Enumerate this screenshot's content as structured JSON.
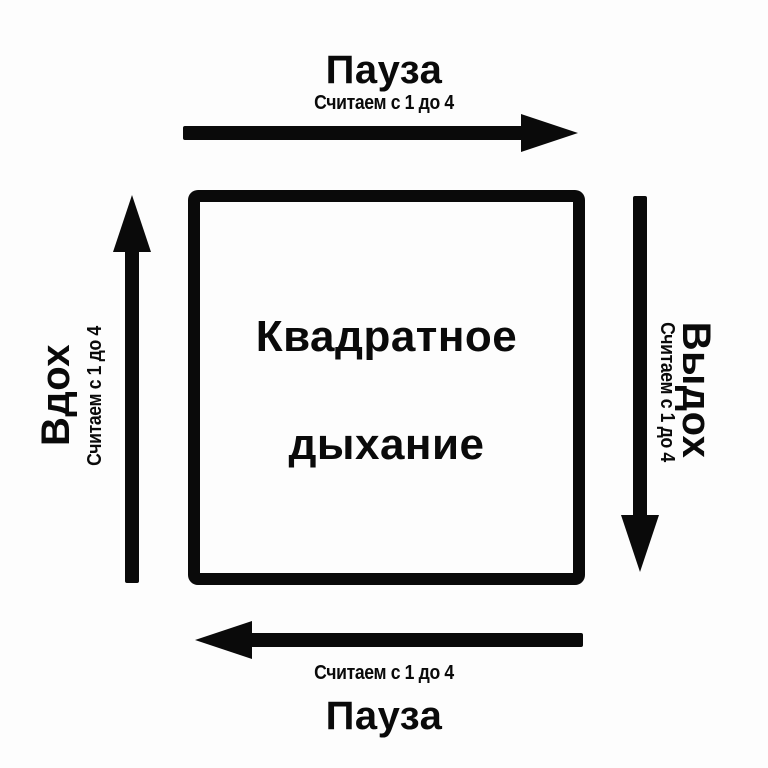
{
  "diagram": {
    "kind": "box-breathing-cycle",
    "title": {
      "line1": "Квадратное",
      "line2": "дыхание"
    }
  },
  "sides": {
    "top": {
      "label": "Пауза",
      "count_note": "Считаем с 1 до 4",
      "arrow_direction": "right",
      "icon": "arrow-right-icon"
    },
    "right": {
      "label": "Выдох",
      "count_note": "Считаем с 1 до 4",
      "arrow_direction": "down",
      "icon": "arrow-down-icon"
    },
    "bottom": {
      "label": "Пауза",
      "count_note": "Считаем с 1 до 4",
      "arrow_direction": "left",
      "icon": "arrow-left-icon"
    },
    "left": {
      "label": "Вдох",
      "count_note": "Считаем с 1 до 4",
      "arrow_direction": "up",
      "icon": "arrow-up-icon"
    }
  },
  "colors": {
    "ink": "#0a0a0a",
    "background": "#fdfdfd"
  }
}
